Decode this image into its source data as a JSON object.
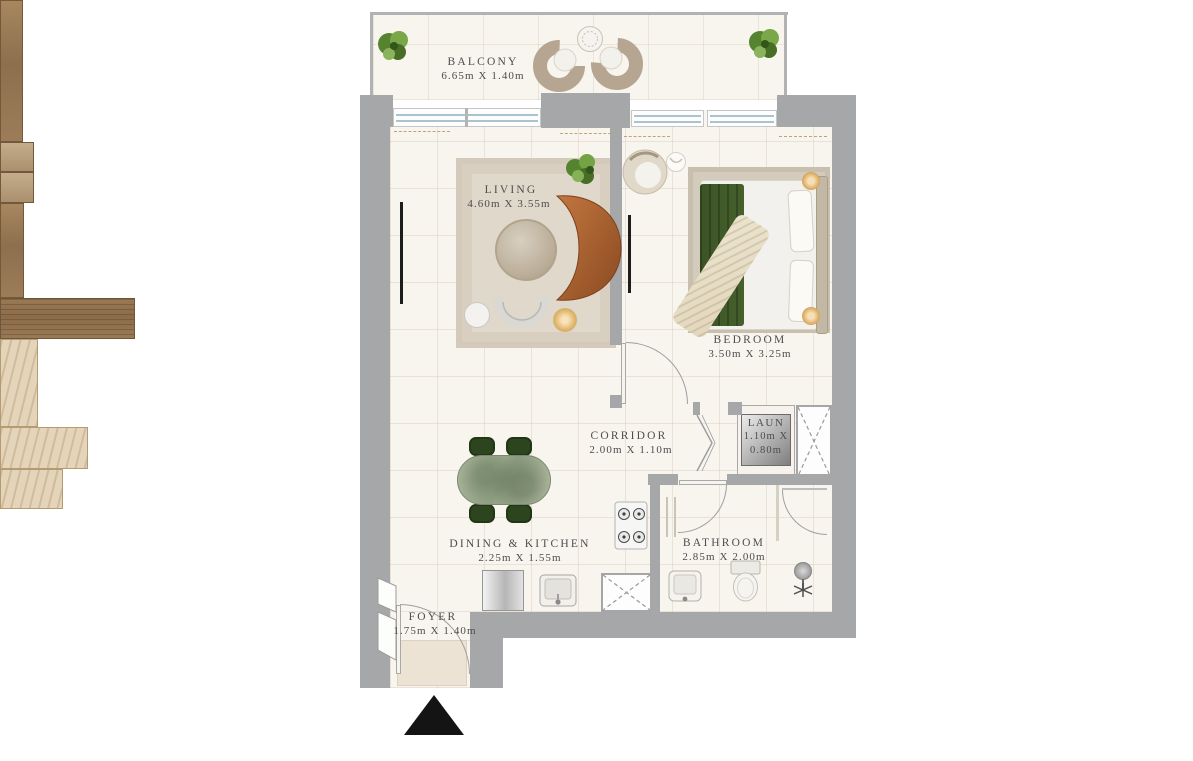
{
  "plan": {
    "type": "apartment-floor-plan",
    "rooms": {
      "balcony": {
        "name": "BALCONY",
        "dims": "6.65m X 1.40m"
      },
      "living": {
        "name": "LIVING",
        "dims": "4.60m X 3.55m"
      },
      "bedroom": {
        "name": "BEDROOM",
        "dims": "3.50m X 3.25m"
      },
      "corridor": {
        "name": "CORRIDOR",
        "dims": "2.00m X 1.10m"
      },
      "laundry": {
        "name": "LAUN",
        "dims_line1": "1.10m X",
        "dims_line2": "0.80m"
      },
      "dining_kitchen": {
        "name": "DINING & KITCHEN",
        "dims": "2.25m X 1.55m"
      },
      "bathroom": {
        "name": "BATHROOM",
        "dims": "2.85m X 2.00m"
      },
      "foyer": {
        "name": "FOYER",
        "dims": "1.75m X 1.40m"
      }
    },
    "colors": {
      "wall": "#a5a7a8",
      "floor": "#f8f4ee",
      "background": "#ffffff",
      "label_text": "#4d4d4d",
      "wood": "#9a7a5a",
      "sofa_leather": "#b06331",
      "bed_blanket_green": "#3c5426",
      "dining_chair_green": "#2c451f",
      "counter_marble": "#e0d2b8",
      "plant_green": "#6d9a3a",
      "window_glass": "#a9c3cf",
      "entrance_marker": "#141414"
    }
  }
}
